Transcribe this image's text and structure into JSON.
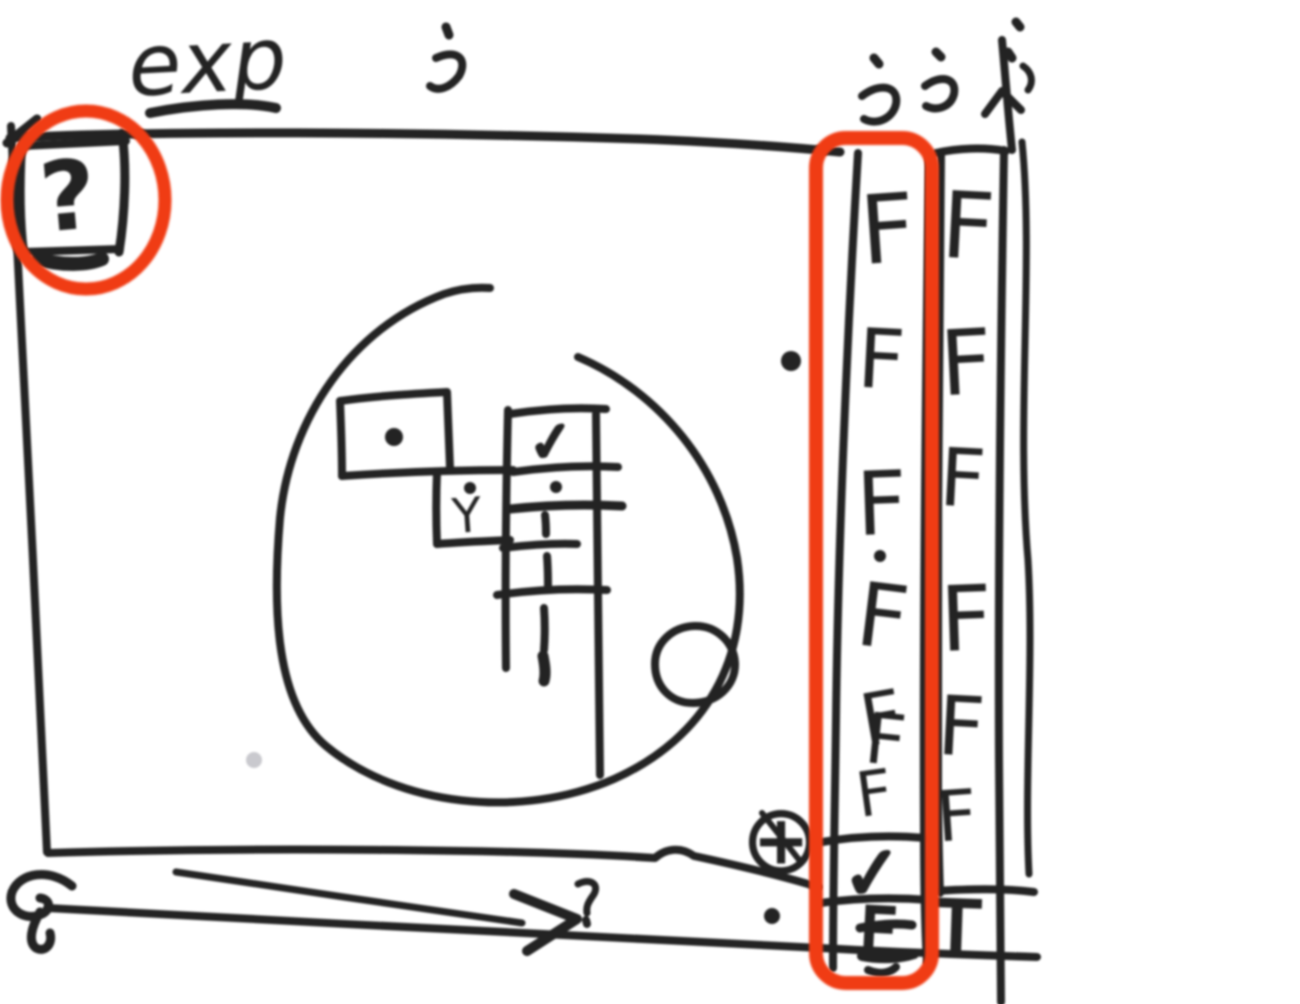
{
  "sketch": {
    "heading": "exp",
    "question_box": {
      "glyph": "?"
    },
    "marks": {
      "checkbox_check": "✓",
      "y_mark": "Y",
      "plus_circled": "⊕"
    },
    "columns": {
      "a": {
        "rows": [
          "F",
          "F",
          "F",
          "F",
          "F",
          "F"
        ],
        "double_extra": "F",
        "check": "✓",
        "footer": "F"
      },
      "b": {
        "rows": [
          "F",
          "F",
          "F",
          "F",
          "F",
          "F"
        ],
        "footer": "T"
      }
    },
    "colors": {
      "ink": "#232323",
      "annotation": "#f03c14",
      "background": "#ffffff"
    }
  }
}
